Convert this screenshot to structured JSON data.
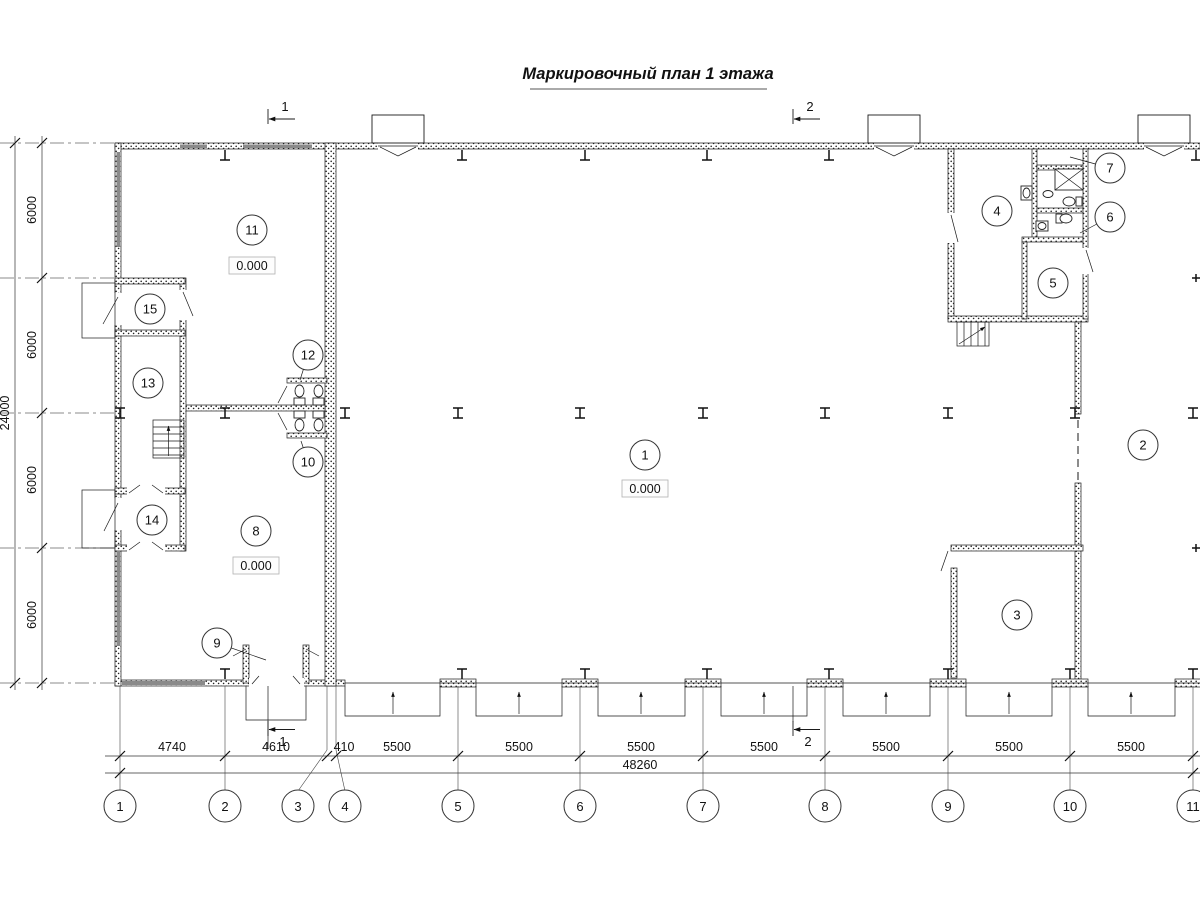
{
  "title": "Маркировочный план 1 этажа",
  "axes_bottom": [
    {
      "label": "1",
      "x": 120
    },
    {
      "label": "2",
      "x": 225
    },
    {
      "label": "3",
      "x": 327,
      "cx": 298
    },
    {
      "label": "4",
      "x": 336,
      "cx": 345
    },
    {
      "label": "5",
      "x": 458
    },
    {
      "label": "6",
      "x": 580
    },
    {
      "label": "7",
      "x": 703
    },
    {
      "label": "8",
      "x": 825
    },
    {
      "label": "9",
      "x": 948
    },
    {
      "label": "10",
      "x": 1070
    },
    {
      "label": "11",
      "x": 1193
    }
  ],
  "dims_bottom": [
    {
      "value": "4740",
      "cx": 172
    },
    {
      "value": "4610",
      "cx": 276
    },
    {
      "value": "410",
      "cx": 344
    },
    {
      "value": "5500",
      "cx": 397
    },
    {
      "value": "5500",
      "cx": 519
    },
    {
      "value": "5500",
      "cx": 641
    },
    {
      "value": "5500",
      "cx": 764
    },
    {
      "value": "5500",
      "cx": 886
    },
    {
      "value": "5500",
      "cx": 1009
    },
    {
      "value": "5500",
      "cx": 1131
    }
  ],
  "total_bottom": {
    "value": "48260",
    "cx": 640
  },
  "dims_left": [
    {
      "value": "6000",
      "cy": 210
    },
    {
      "value": "6000",
      "cy": 345
    },
    {
      "value": "6000",
      "cy": 480
    },
    {
      "value": "6000",
      "cy": 615
    }
  ],
  "total_left": {
    "value": "24000",
    "cy": 413
  },
  "rooms": [
    {
      "n": "1",
      "x": 645,
      "y": 455,
      "elev": "0.000",
      "ex": 645,
      "ey": 489
    },
    {
      "n": "2",
      "x": 1143,
      "y": 445
    },
    {
      "n": "3",
      "x": 1017,
      "y": 615
    },
    {
      "n": "4",
      "x": 997,
      "y": 211
    },
    {
      "n": "5",
      "x": 1053,
      "y": 283
    },
    {
      "n": "6",
      "x": 1110,
      "y": 217,
      "lx": 1080,
      "ly": 233
    },
    {
      "n": "7",
      "x": 1110,
      "y": 168,
      "lx": 1070,
      "ly": 157
    },
    {
      "n": "8",
      "x": 256,
      "y": 531,
      "elev": "0.000",
      "ex": 256,
      "ey": 566
    },
    {
      "n": "9",
      "x": 217,
      "y": 643,
      "lx": 266,
      "ly": 660
    },
    {
      "n": "10",
      "x": 308,
      "y": 462,
      "lx": 301,
      "ly": 441
    },
    {
      "n": "11",
      "x": 252,
      "y": 230,
      "elev": "0.000",
      "ex": 252,
      "ey": 266
    },
    {
      "n": "12",
      "x": 308,
      "y": 355,
      "lx": 300,
      "ly": 380
    },
    {
      "n": "13",
      "x": 148,
      "y": 383
    },
    {
      "n": "14",
      "x": 152,
      "y": 520
    },
    {
      "n": "15",
      "x": 150,
      "y": 309
    }
  ],
  "sections": [
    {
      "label": "1",
      "x": 268
    },
    {
      "label": "2",
      "x": 793
    }
  ]
}
